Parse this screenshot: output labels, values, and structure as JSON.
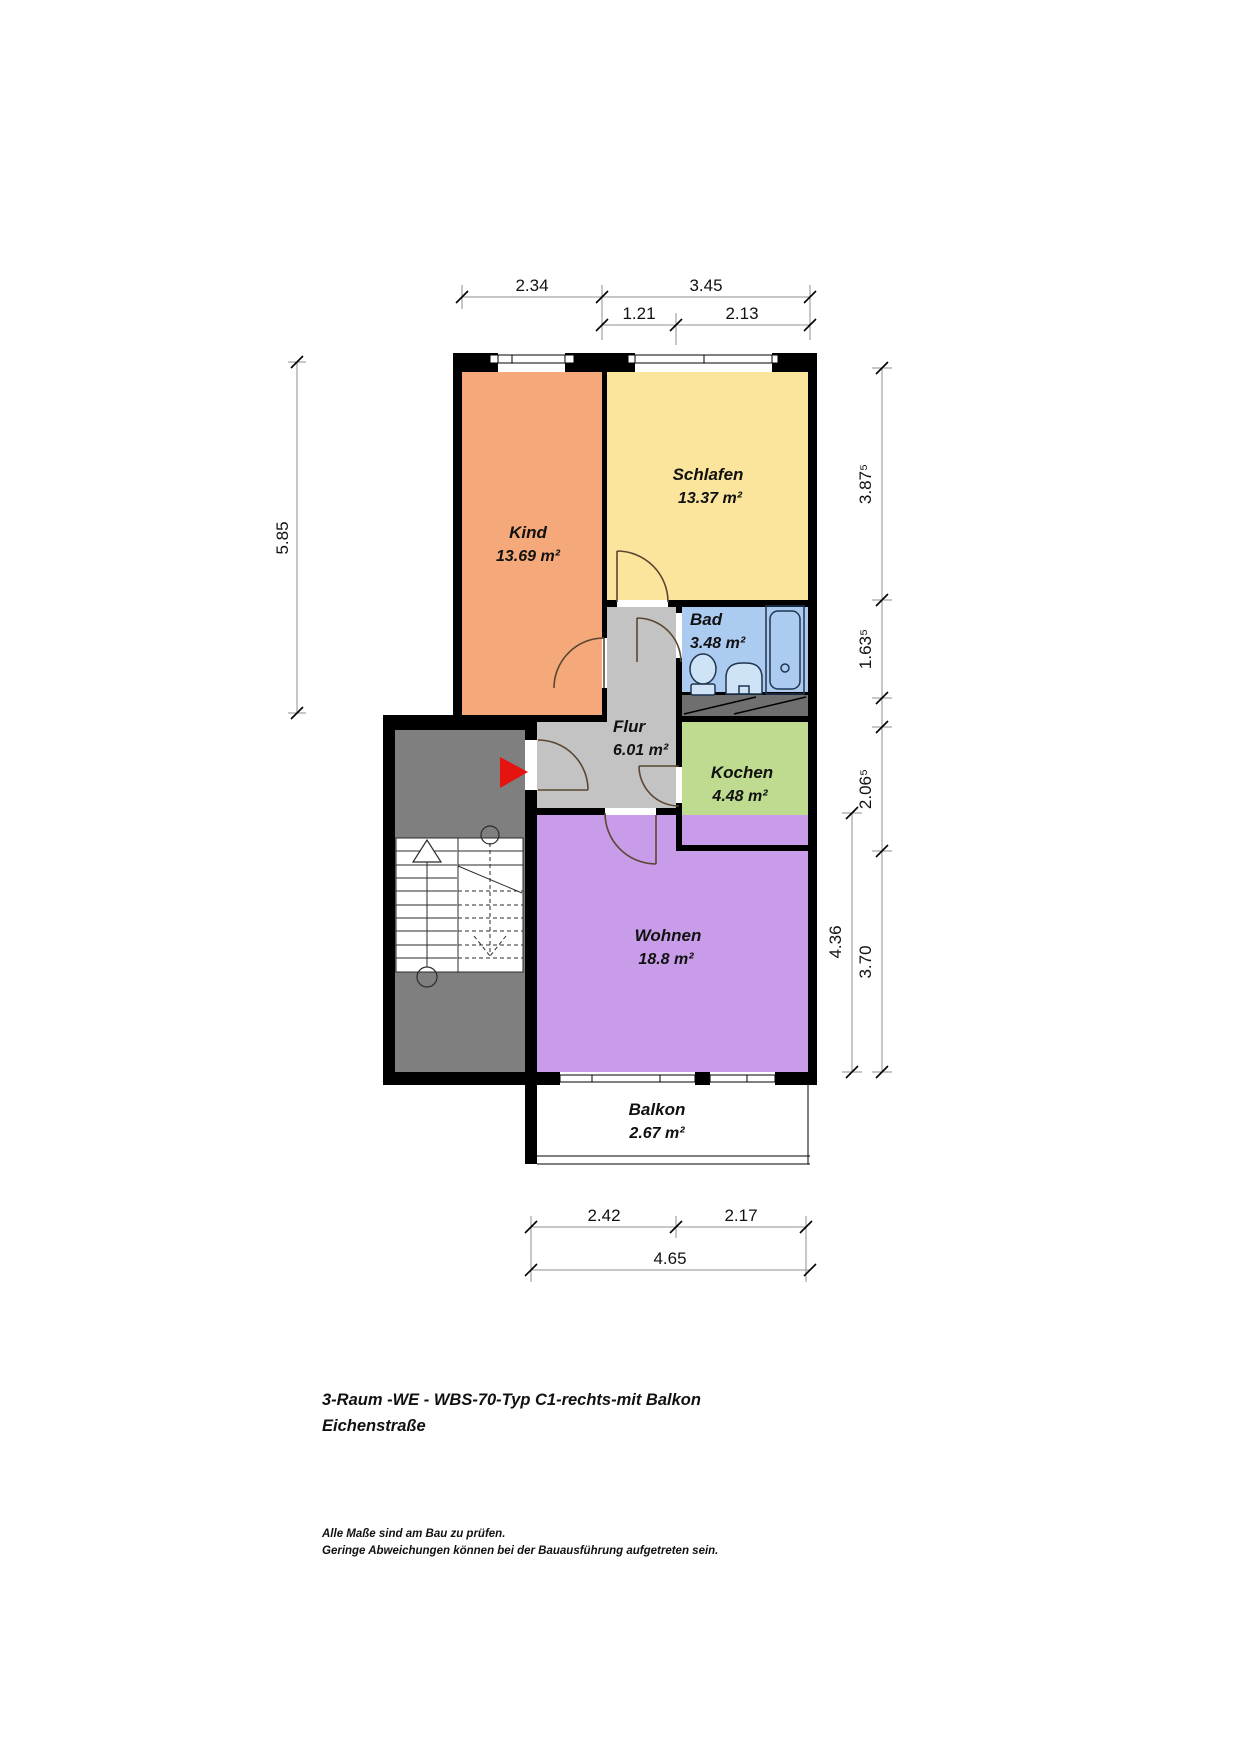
{
  "title": {
    "line1": "3-Raum -WE - WBS-70-Typ C1-rechts-mit Balkon",
    "line2": "Eichenstraße"
  },
  "notes": {
    "line1": "Alle Maße sind am Bau zu prüfen.",
    "line2": "Geringe Abweichungen können bei der Bauausführung aufgetreten sein."
  },
  "rooms": {
    "kind": {
      "name": "Kind",
      "area": "13.69 m²",
      "color": "#f5a97a"
    },
    "schlafen": {
      "name": "Schlafen",
      "area": "13.37 m²",
      "color": "#fbe59c"
    },
    "bad": {
      "name": "Bad",
      "area": "3.48 m²",
      "color": "#abccf0"
    },
    "flur": {
      "name": "Flur",
      "area": "6.01 m²",
      "color": "#c3c3c3"
    },
    "kochen": {
      "name": "Kochen",
      "area": "4.48 m²",
      "color": "#bedb90"
    },
    "wohnen": {
      "name": "Wohnen",
      "area": "18.8 m²",
      "color": "#c99cea"
    },
    "balkon": {
      "name": "Balkon",
      "area": "2.67 m²",
      "color": "#ffffff"
    }
  },
  "dims": {
    "top_row1": [
      "2.34",
      "3.45"
    ],
    "top_row2": [
      "1.21",
      "2.13"
    ],
    "left": [
      "5.85"
    ],
    "right": [
      "3.87⁵",
      "1.63⁵",
      "2.06⁵",
      "3.70"
    ],
    "right_inner": [
      "4.36"
    ],
    "bottom_row1": [
      "2.42",
      "2.17"
    ],
    "bottom_row2": [
      "4.65"
    ]
  },
  "colors": {
    "stairwell": "#7f7f7f",
    "shaft": "#6f6f6f",
    "corridor": "#c3c3c3",
    "entrance_arrow": "#e61410",
    "fixture_fill": "#cfe3f7"
  }
}
